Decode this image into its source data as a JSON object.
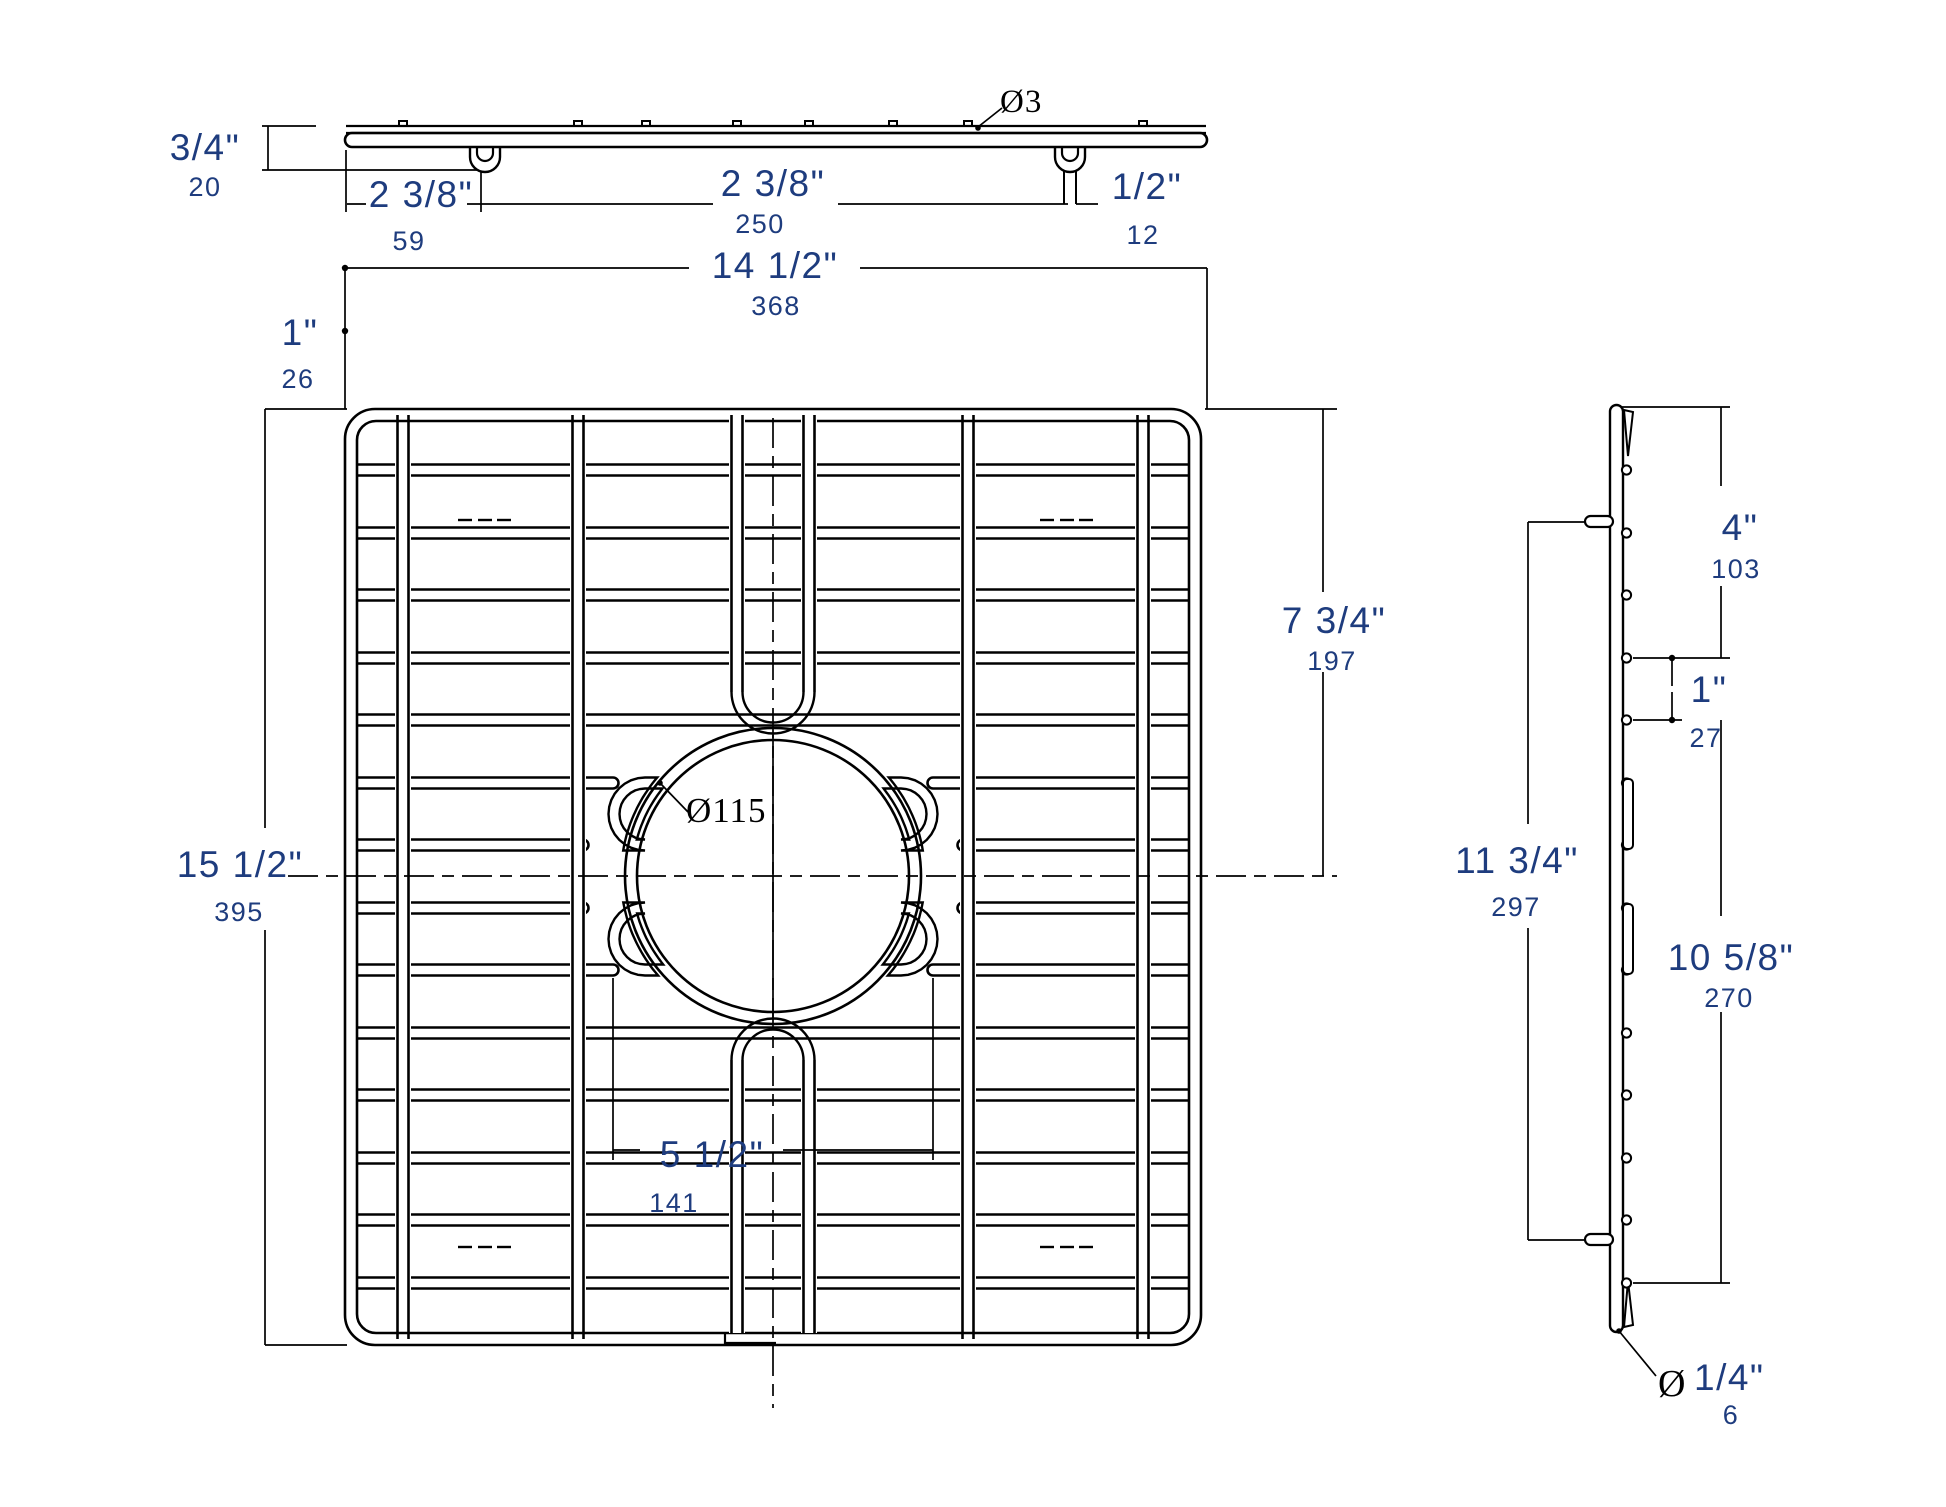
{
  "title": "Sink grid technical dimension drawing",
  "colors": {
    "line": "#000000",
    "label_blue": "#1e3c7e",
    "background": "#ffffff"
  },
  "views": {
    "top": {
      "name": "top profile view of grid"
    },
    "front": {
      "name": "front plan view of grid with drain hole"
    },
    "side": {
      "name": "right side profile view of grid"
    }
  },
  "dims": {
    "bar_thickness": {
      "inch": "3/4\"",
      "mm": "20"
    },
    "foot_offset": {
      "inch": "2 3/8\"",
      "mm": "59"
    },
    "foot_spacing": {
      "inch": "2 3/8\"",
      "mm": "250"
    },
    "foot_width": {
      "inch": "1/2\"",
      "mm": "12"
    },
    "wire_diameter": {
      "label": "Ø3"
    },
    "overall_width": {
      "inch": "14 1/2\"",
      "mm": "368"
    },
    "edge_to_wire": {
      "inch": "1\"",
      "mm": "26"
    },
    "overall_depth": {
      "inch": "15 1/2\"",
      "mm": "395"
    },
    "top_to_center": {
      "inch": "7 3/4\"",
      "mm": "197"
    },
    "hole_offset": {
      "inch": "5 1/2\"",
      "mm": "141"
    },
    "hole_diameter": {
      "label": "Ø115"
    },
    "side_top_span": {
      "inch": "4\"",
      "mm": "103"
    },
    "side_wire_gap": {
      "inch": "1\"",
      "mm": "27"
    },
    "feet_spacing": {
      "inch": "11 3/4\"",
      "mm": "297"
    },
    "side_lower_span": {
      "inch": "10 5/8\"",
      "mm": "270"
    },
    "foot_wire": {
      "prefix": "Ø",
      "inch": "1/4\"",
      "mm": "6"
    }
  }
}
